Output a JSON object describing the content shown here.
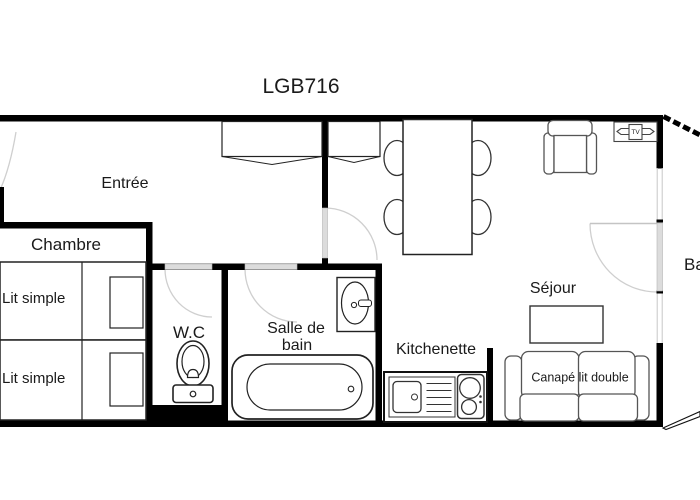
{
  "title": "LGB716",
  "rooms": {
    "entree": "Entrée",
    "chambre": "Chambre",
    "wc": "W.C",
    "bain_line1": "Salle de",
    "bain_line2": "bain",
    "kitchenette": "Kitchenette",
    "sejour": "Séjour",
    "balcon": "Ba"
  },
  "furniture": {
    "bed1": "Lit simple",
    "bed2": "Lit simple",
    "sofa": "Canapé lit double",
    "tv": "TV"
  },
  "colors": {
    "wall": "#000000",
    "door_fill": "#dcdcdc",
    "door_arc": "#cfcfcf",
    "furniture_outline": "#333333",
    "text": "#1a1a1a",
    "background": "#ffffff"
  }
}
